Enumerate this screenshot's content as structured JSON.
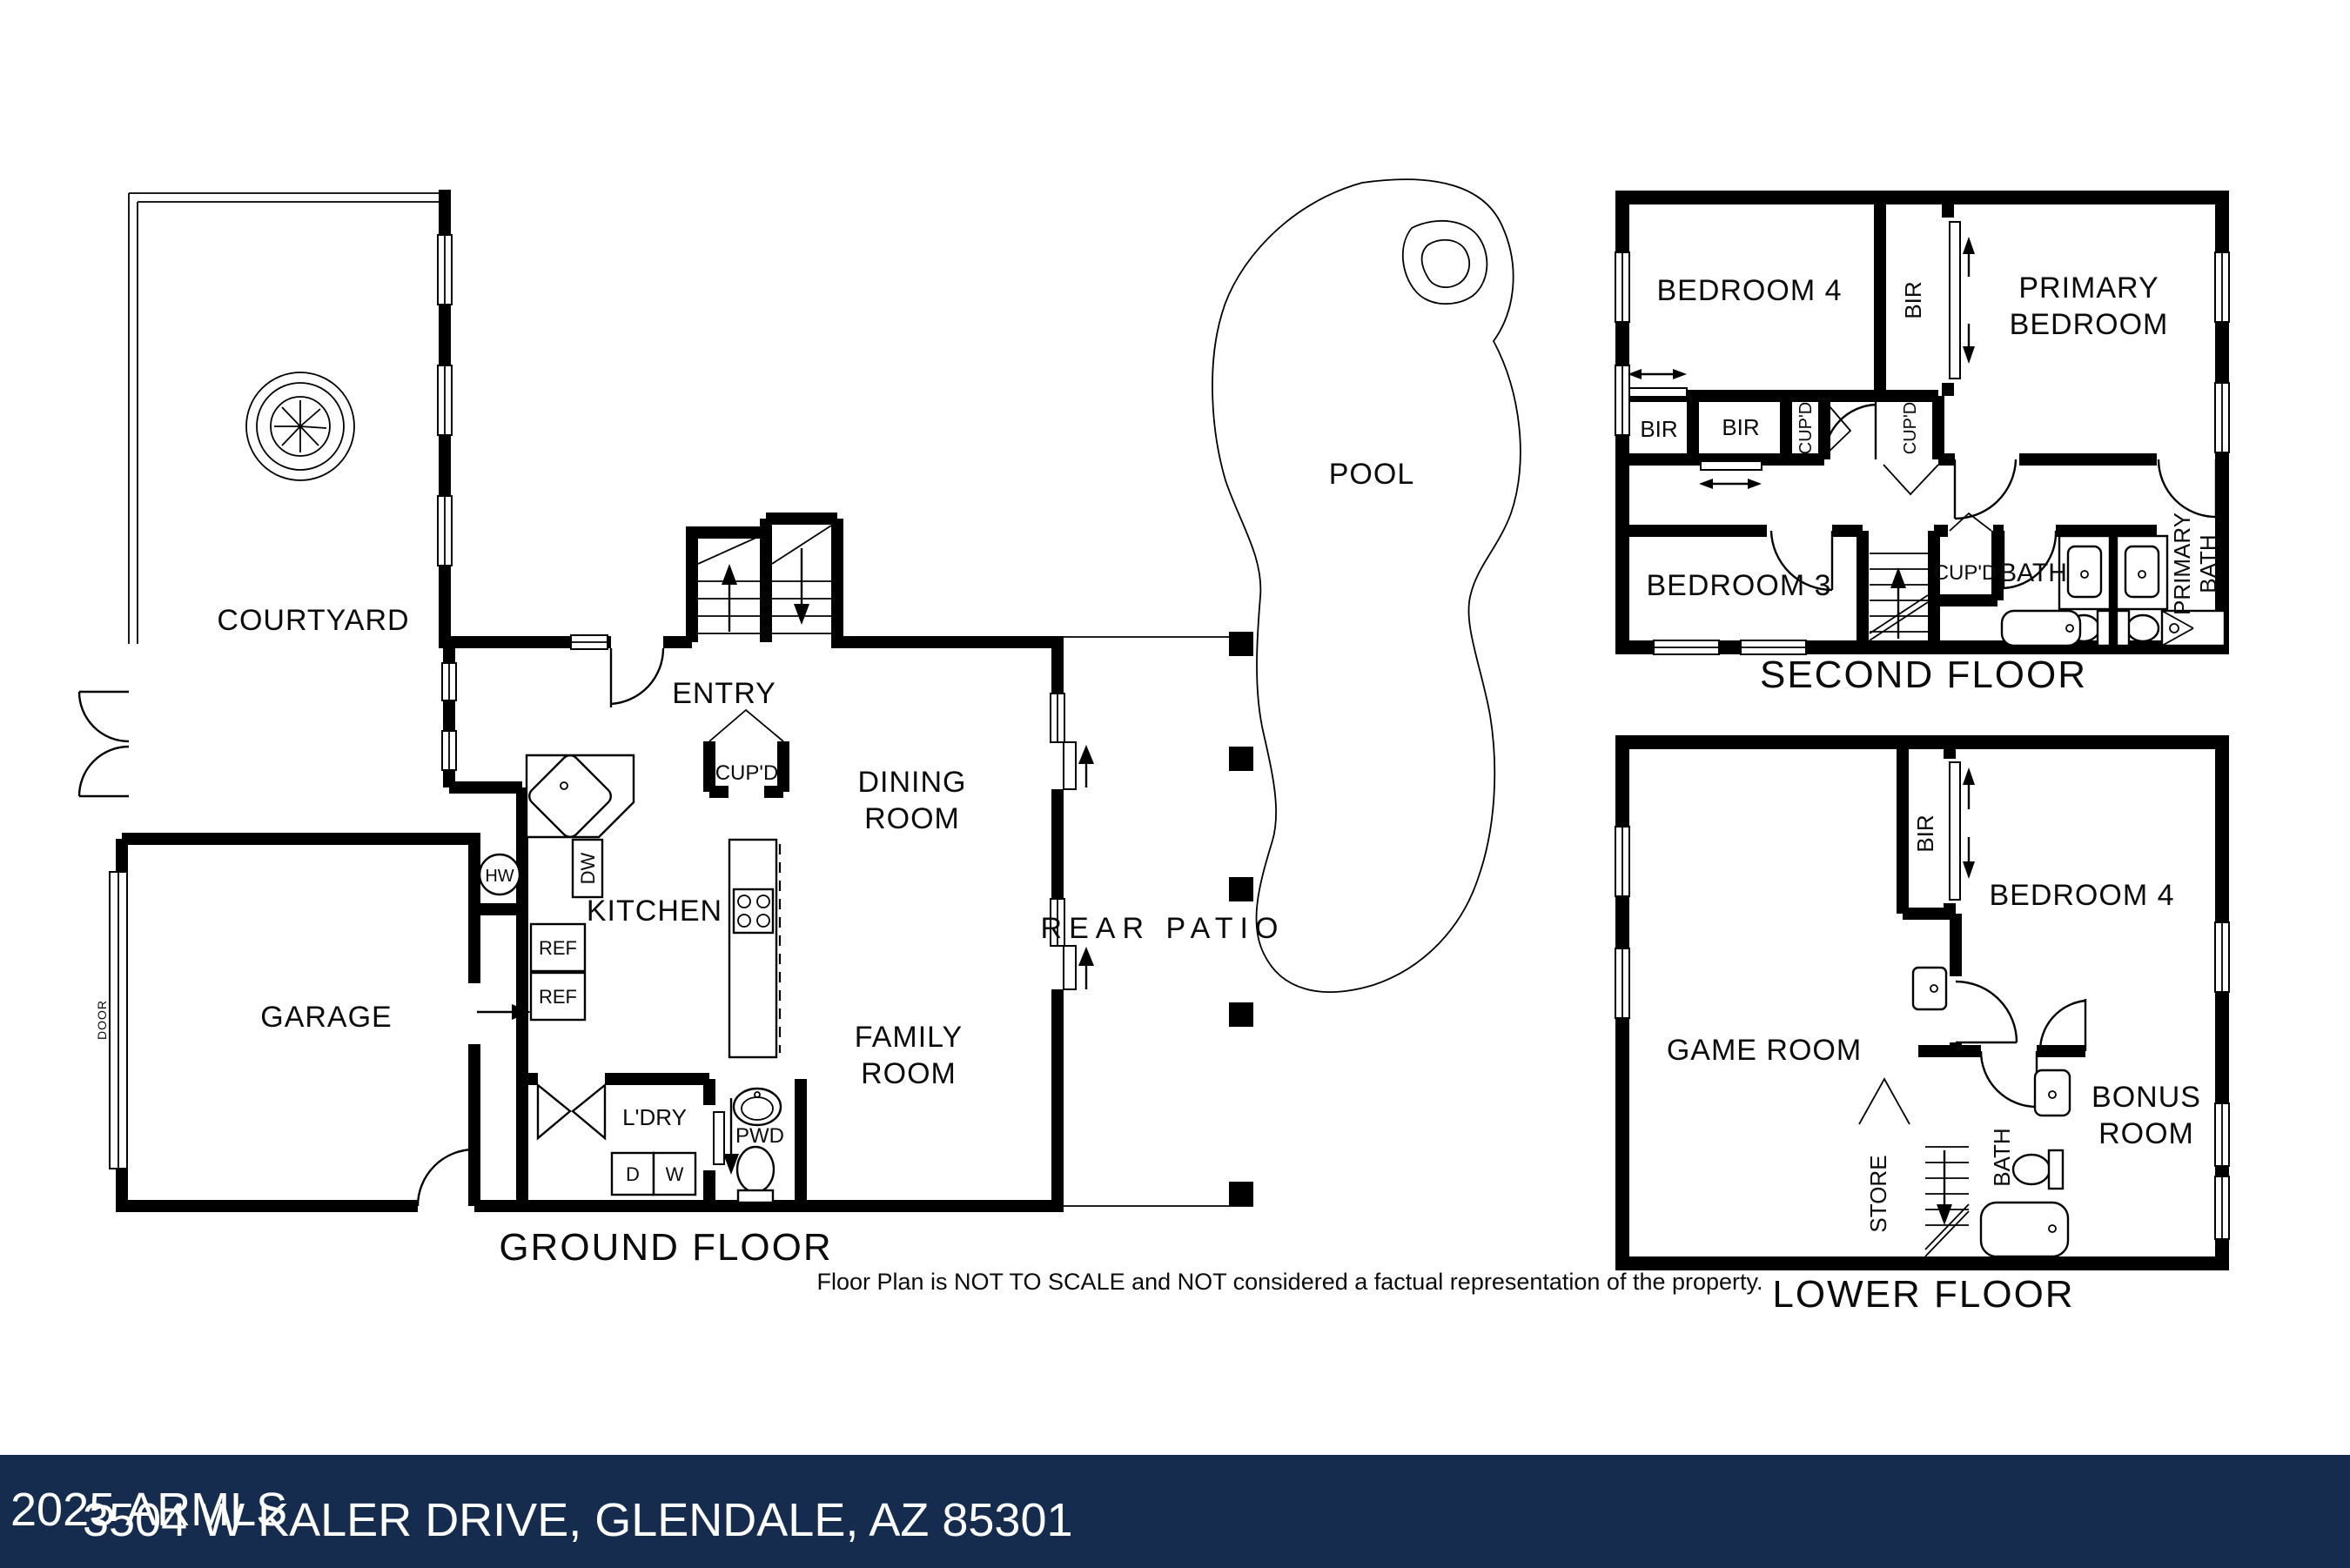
{
  "page": {
    "background": "#ffffff",
    "line_color": "#000000",
    "disclaimer": "Floor Plan is NOT TO SCALE and NOT considered a factual representation of the property.",
    "footer": {
      "bar_color": "#152C4E",
      "text_color": "#ffffff",
      "copyright": "2025 ARMLS",
      "address": "3504 W KALER DRIVE, GLENDALE, AZ 85301"
    }
  },
  "labels": {
    "bir": "BIR",
    "cupd": "CUP'D",
    "ref": "REF",
    "dw": "DW",
    "hw": "HW",
    "d": "D",
    "w": "W",
    "pwd": "PWD",
    "ldry": "L'DRY",
    "bath": "BATH",
    "store": "STORE",
    "door": "DOOR",
    "pool": "POOL"
  },
  "floors": {
    "ground": {
      "title": "GROUND FLOOR",
      "courtyard": "COURTYARD",
      "entry": "ENTRY",
      "kitchen": "KITCHEN",
      "garage": "GARAGE",
      "dining_line1": "DINING",
      "dining_line2": "ROOM",
      "family_line1": "FAMILY",
      "family_line2": "ROOM",
      "rear_patio": "REAR PATIO"
    },
    "second": {
      "title": "SECOND FLOOR",
      "bedroom4": "BEDROOM 4",
      "primary_line1": "PRIMARY",
      "primary_line2": "BEDROOM",
      "bedroom3": "BEDROOM 3",
      "primary_bath_line1": "PRIMARY",
      "primary_bath_line2": "BATH"
    },
    "lower": {
      "title": "LOWER FLOOR",
      "game_room": "GAME ROOM",
      "bedroom4": "BEDROOM 4",
      "bonus_line1": "BONUS",
      "bonus_line2": "ROOM"
    }
  }
}
